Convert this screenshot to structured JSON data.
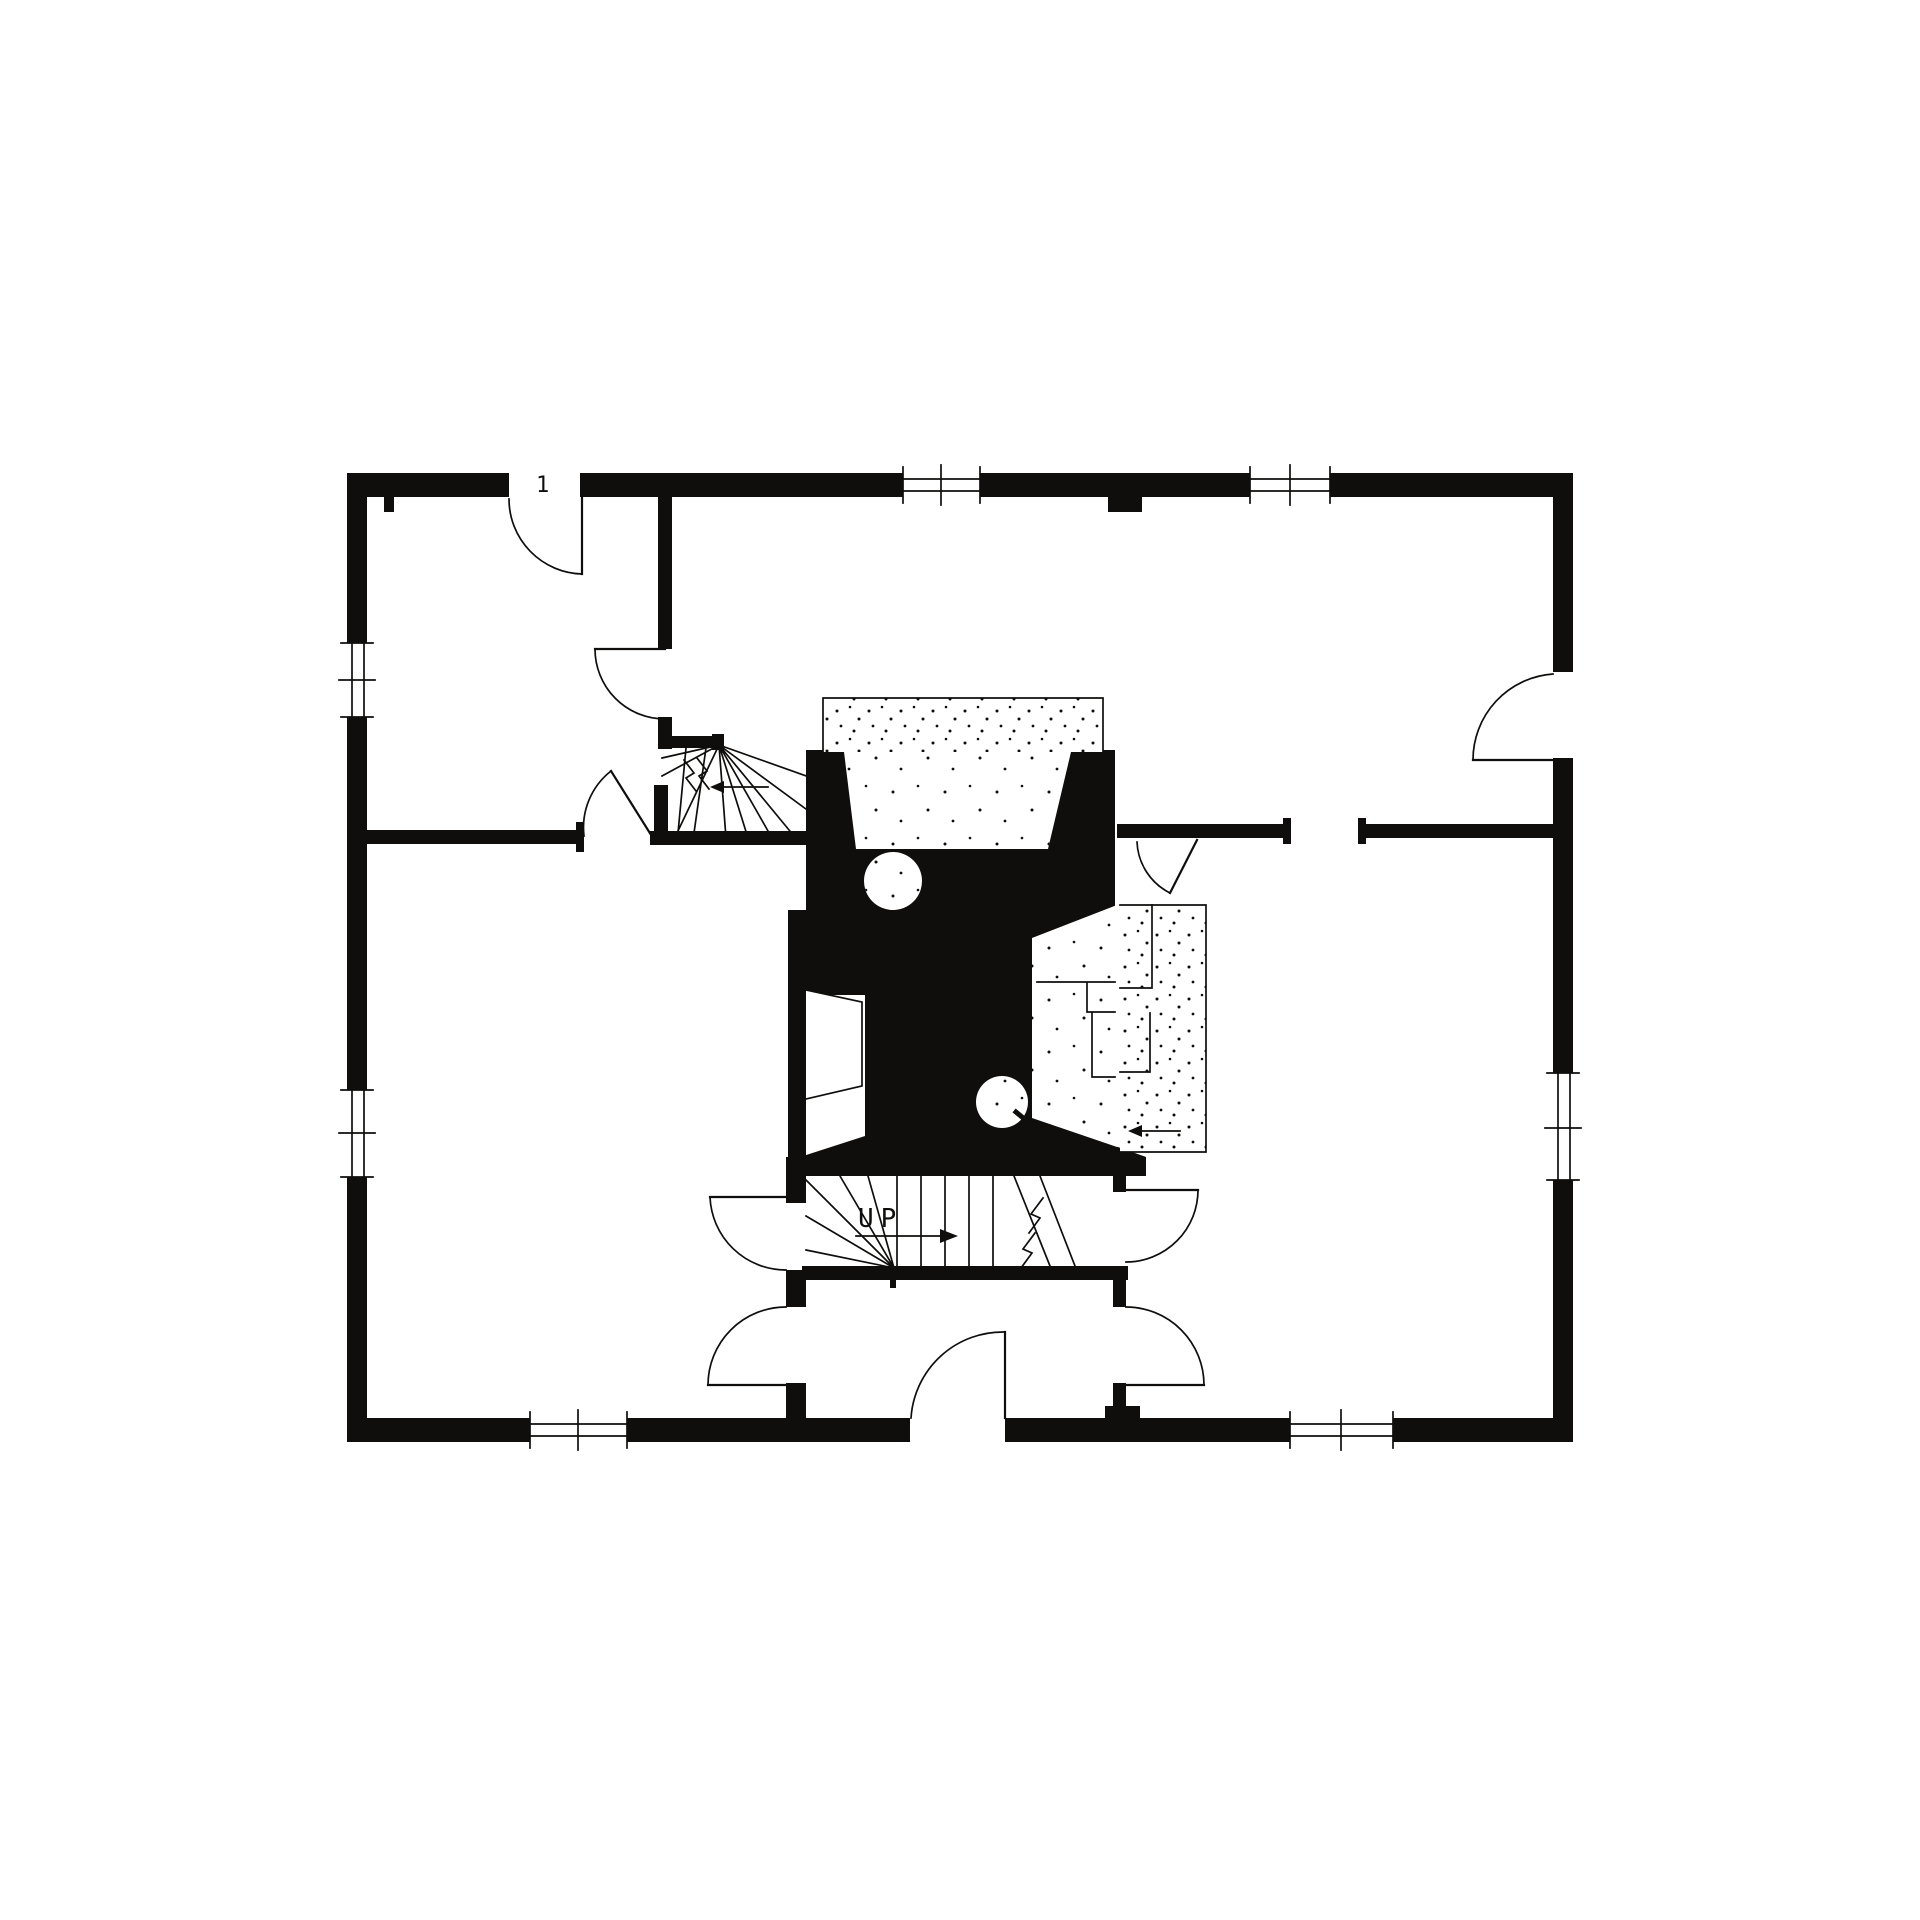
{
  "canvas": {
    "width": 1920,
    "height": 1920
  },
  "colors": {
    "ink": "#0f0e0c",
    "paper": "#ffffff"
  },
  "annotations": {
    "stair_label": "UP",
    "door_tag": "1"
  },
  "plan": {
    "type": "first-floor-plan",
    "drawing_style": "black-ink measured drawing, poche walls",
    "features": [
      "central-chimney-mass",
      "north-fireplace-with-hearth",
      "east-fireplace-with-hearth",
      "west-fireplace",
      "bake-oven-north",
      "bake-oven-south",
      "front-winder-stair-up",
      "rear-winder-stair",
      "front-entrance-door",
      "back-door",
      "east-side-door"
    ],
    "window_count": 7,
    "room_count": 5
  }
}
